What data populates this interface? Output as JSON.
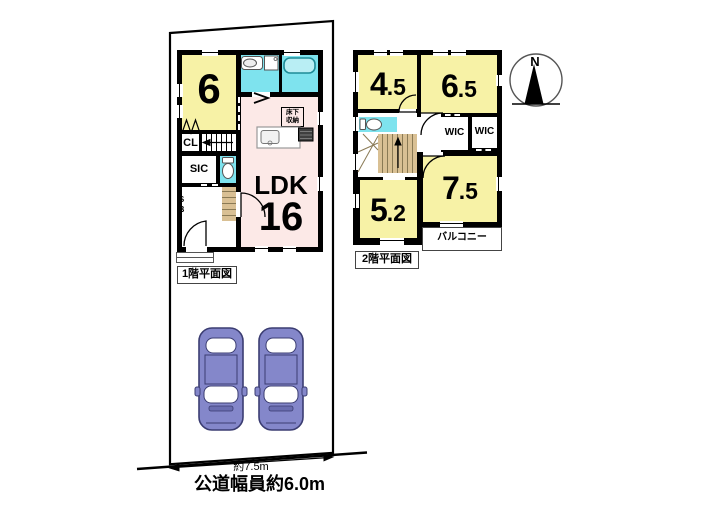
{
  "site": {
    "frontage_label": "約7.5m",
    "road_label": "公道幅員約6.0m"
  },
  "compass": {
    "north": "N"
  },
  "floor1": {
    "caption": "1階平面図",
    "bedroom_size": "6",
    "ldk_name": "LDK",
    "ldk_size": "16",
    "closet": "CL",
    "shoe_in_closet": "SIC",
    "shoe_box": "SB",
    "floor_storage_line1": "床下",
    "floor_storage_line2": "収納"
  },
  "floor2": {
    "caption": "2階平面図",
    "room_a": {
      "int": "4",
      "dec": ".5"
    },
    "room_b": {
      "int": "6",
      "dec": ".5"
    },
    "room_c": {
      "int": "5",
      "dec": ".2"
    },
    "room_d": {
      "int": "7",
      "dec": ".5"
    },
    "wic_left": "WIC",
    "wic_right": "WIC",
    "balcony": "バルコニー"
  },
  "colors": {
    "room_yellow": "#f7f2a6",
    "ldk_pink": "#fce9e7",
    "water_cyan": "#7ee3ee",
    "stair_tan": "#d9c094",
    "car_purple": "#8487ca",
    "wall": "#000000"
  }
}
